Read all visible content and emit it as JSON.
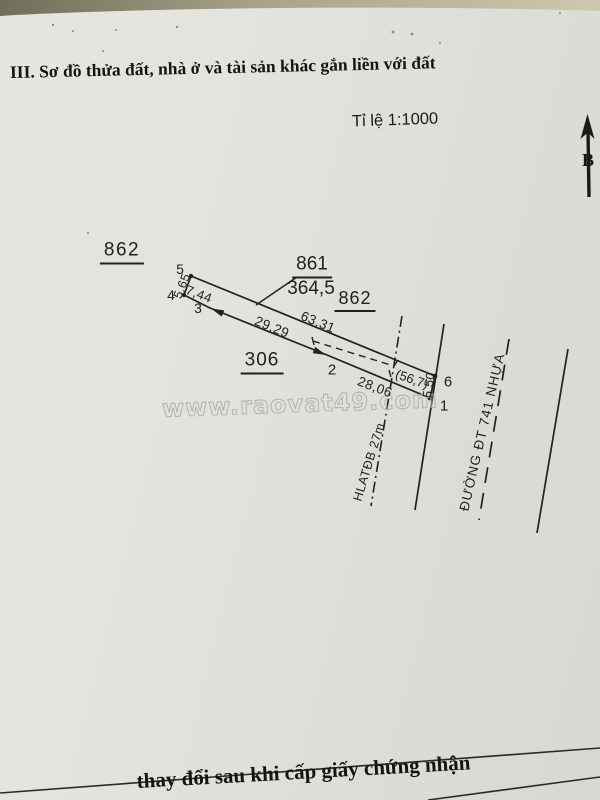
{
  "document": {
    "section_title": "III. Sơ đồ thửa đất, nhà ở và tài sản khác gắn liền với đất",
    "scale_label": "Tỉ lệ 1:1000",
    "north_label": "B",
    "watermark": "www.raovat49.com",
    "footer_text": "thay đổi sau khi cấp giấy chứng nhận"
  },
  "parcel": {
    "number": "861",
    "area_m2": "364,5",
    "corridor_area_m2": "(56,7)",
    "points": {
      "p1": "1",
      "p2": "2",
      "p3": "3",
      "p4": "4",
      "p5": "5",
      "p6": "6"
    },
    "dimensions": {
      "top_edge": "63,31",
      "front_edge": "5,50",
      "bottom_right_edge": "28,06",
      "bottom_left_edge": "29,29",
      "rear_lower_edge": "7,44",
      "rear_upper_edge": "5,65"
    }
  },
  "neighbors": {
    "parcel_left": "862",
    "parcel_right": "862",
    "parcel_bottom": "306"
  },
  "roads": {
    "corridor_label": "HLATĐB 27m",
    "road_name": "ĐƯỜNG ĐT 741 NHỰA"
  },
  "colors": {
    "paper": "#e0e1db",
    "ink": "#21211d",
    "watermark_stroke": "#adafa8"
  }
}
